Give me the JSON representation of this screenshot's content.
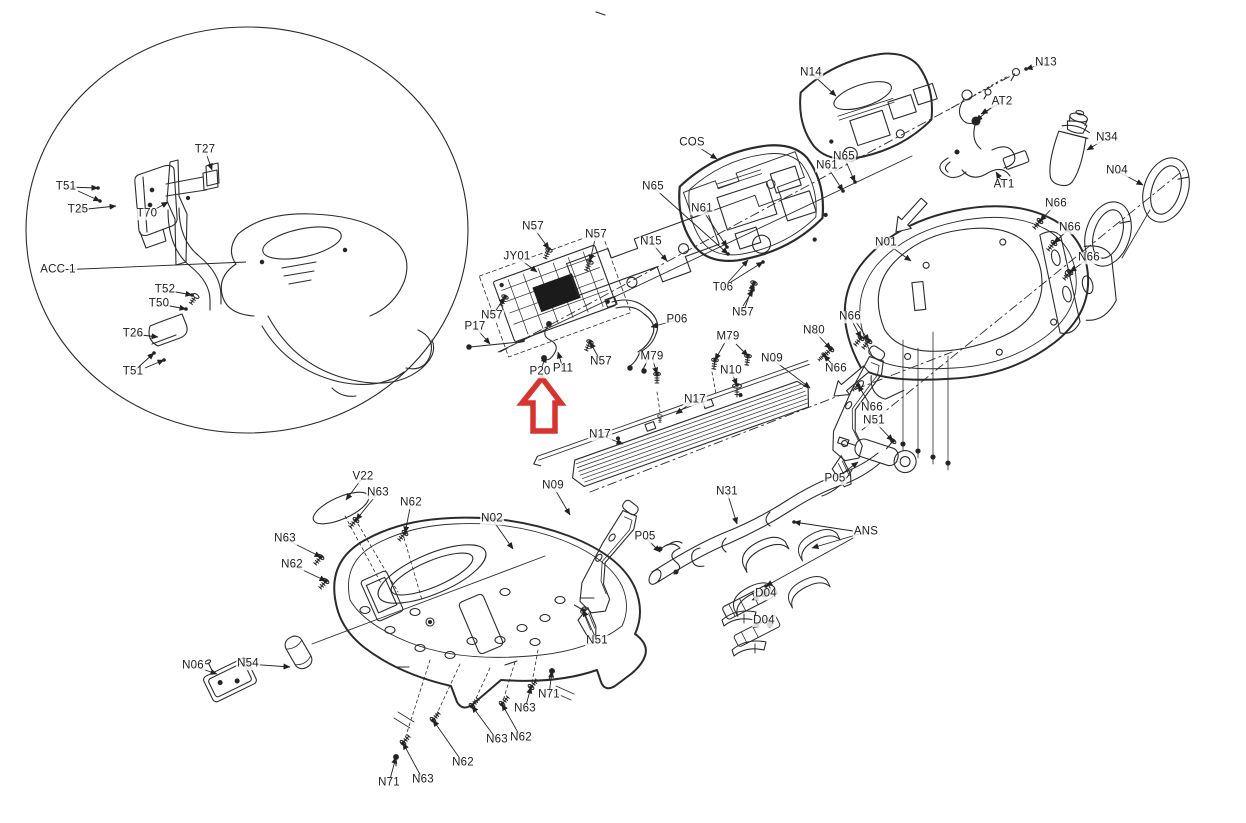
{
  "diagram": {
    "kind": "exploded-parts-diagram",
    "line_color": "#2b2b2b",
    "leader_color": "#222222",
    "label_color": "#1d1d1f",
    "highlight": {
      "icon": "up-arrow",
      "color": "#d7342e"
    }
  },
  "labels": [
    {
      "text": "T27",
      "x": 205,
      "y": 150,
      "lx": 212,
      "ly": 170
    },
    {
      "text": "T51",
      "x": 66,
      "y": 187,
      "lx": 98,
      "ly": 188,
      "hw": true
    },
    {
      "text": "T25",
      "x": 78,
      "y": 210,
      "lx": 116,
      "ly": 206
    },
    {
      "text": "T70",
      "x": 147,
      "y": 214,
      "lx": 168,
      "ly": 202
    },
    {
      "text": "ACC-1",
      "x": 58,
      "y": 270,
      "lx": 246,
      "ly": 262,
      "arrow": false
    },
    {
      "text": "T52",
      "x": 165,
      "y": 290,
      "lx": 192,
      "ly": 295,
      "hw": true
    },
    {
      "text": "T50",
      "x": 159,
      "y": 304,
      "lx": 186,
      "ly": 309,
      "hw": true
    },
    {
      "text": "T26",
      "x": 133,
      "y": 334,
      "lx": 158,
      "ly": 337
    },
    {
      "text": "T51",
      "x": 133,
      "y": 372,
      "lx": 154,
      "ly": 353,
      "hw": true
    },
    {
      "text": "N14",
      "x": 811,
      "y": 73,
      "lx": 836,
      "ly": 96
    },
    {
      "text": "N13",
      "x": 1046,
      "y": 63,
      "lx": 1026,
      "ly": 69,
      "hw": true
    },
    {
      "text": "AT2",
      "x": 1002,
      "y": 102,
      "lx": 981,
      "ly": 114
    },
    {
      "text": "AT1",
      "x": 1004,
      "y": 185,
      "lx": 996,
      "ly": 172
    },
    {
      "text": "N34",
      "x": 1107,
      "y": 138,
      "lx": 1087,
      "ly": 150
    },
    {
      "text": "N04",
      "x": 1117,
      "y": 171,
      "lx": 1143,
      "ly": 185
    },
    {
      "text": "COS",
      "x": 692,
      "y": 143,
      "lx": 717,
      "ly": 159
    },
    {
      "text": "N65",
      "x": 844,
      "y": 157,
      "lx": 855,
      "ly": 182,
      "hw": true
    },
    {
      "text": "N61",
      "x": 827,
      "y": 166,
      "lx": 843,
      "ly": 191,
      "hw": true
    },
    {
      "text": "N65",
      "x": 653,
      "y": 187,
      "lx": 728,
      "ly": 254,
      "hw": true
    },
    {
      "text": "N61",
      "x": 702,
      "y": 209,
      "lx": 727,
      "ly": 247,
      "hw": true
    },
    {
      "text": "N15",
      "x": 651,
      "y": 242,
      "lx": 667,
      "ly": 261
    },
    {
      "text": "N01",
      "x": 886,
      "y": 243,
      "lx": 911,
      "ly": 261
    },
    {
      "text": "N66",
      "x": 1056,
      "y": 204,
      "lx": 1040,
      "ly": 221,
      "hw": true
    },
    {
      "text": "N66",
      "x": 1070,
      "y": 228,
      "lx": 1054,
      "ly": 243,
      "hw": true
    },
    {
      "text": "N66",
      "x": 1089,
      "y": 258,
      "lx": 1070,
      "ly": 272,
      "hw": true
    },
    {
      "text": "N57",
      "x": 533,
      "y": 227,
      "lx": 549,
      "ly": 249,
      "hw": true
    },
    {
      "text": "N57",
      "x": 596,
      "y": 235,
      "lx": 590,
      "ly": 261,
      "hw": true
    },
    {
      "text": "JY01",
      "x": 517,
      "y": 257,
      "lx": 537,
      "ly": 272
    },
    {
      "text": "N57",
      "x": 492,
      "y": 316,
      "lx": 505,
      "ly": 297,
      "hw": true
    },
    {
      "text": "P17",
      "x": 475,
      "y": 327,
      "lx": 490,
      "ly": 344
    },
    {
      "text": "P06",
      "x": 677,
      "y": 320,
      "lx": 651,
      "ly": 327
    },
    {
      "text": "T06",
      "x": 723,
      "y": 288,
      "lx": 748,
      "ly": 260
    },
    {
      "text": "N57",
      "x": 743,
      "y": 313,
      "lx": 754,
      "ly": 283,
      "hw": true
    },
    {
      "text": "P20",
      "x": 540,
      "y": 372,
      "lx": 546,
      "ly": 356
    },
    {
      "text": "P11",
      "x": 563,
      "y": 369,
      "lx": 558,
      "ly": 352
    },
    {
      "text": "N57",
      "x": 601,
      "y": 362,
      "lx": 590,
      "ly": 342,
      "hw": true
    },
    {
      "text": "M79",
      "x": 652,
      "y": 357,
      "lx": 657,
      "ly": 374,
      "hw": true
    },
    {
      "text": "M79",
      "x": 728,
      "y": 337,
      "lx": 715,
      "ly": 360,
      "hw": true
    },
    {
      "text": "N10",
      "x": 731,
      "y": 371,
      "lx": 737,
      "ly": 385,
      "hw": true
    },
    {
      "text": "N17",
      "x": 695,
      "y": 400,
      "lx": 676,
      "ly": 414
    },
    {
      "text": "N17",
      "x": 600,
      "y": 435,
      "lx": 623,
      "ly": 444
    },
    {
      "text": "N09",
      "x": 772,
      "y": 359,
      "lx": 810,
      "ly": 388
    },
    {
      "text": "N80",
      "x": 814,
      "y": 331,
      "lx": 831,
      "ly": 349,
      "hw": true
    },
    {
      "text": "N66",
      "x": 850,
      "y": 317,
      "lx": 861,
      "ly": 338,
      "hw": true
    },
    {
      "text": "N66",
      "x": 836,
      "y": 369,
      "lx": 824,
      "ly": 355,
      "hw": true
    },
    {
      "text": "N66",
      "x": 872,
      "y": 408,
      "lx": 858,
      "ly": 385,
      "hw": true
    },
    {
      "text": "N51",
      "x": 874,
      "y": 421,
      "lx": 893,
      "ly": 441,
      "hw": true
    },
    {
      "text": "P05",
      "x": 835,
      "y": 479,
      "lx": 858,
      "ly": 462
    },
    {
      "text": "N09",
      "x": 553,
      "y": 486,
      "lx": 570,
      "ly": 515
    },
    {
      "text": "N31",
      "x": 727,
      "y": 492,
      "lx": 737,
      "ly": 524
    },
    {
      "text": "P05",
      "x": 645,
      "y": 537,
      "lx": 660,
      "ly": 552
    },
    {
      "text": "ANS",
      "x": 866,
      "y": 532,
      "lx": 812,
      "ly": 548
    },
    {
      "text": "D04",
      "x": 766,
      "y": 594,
      "lx": 752,
      "ly": 600
    },
    {
      "text": "D04",
      "x": 764,
      "y": 621,
      "lx": 753,
      "ly": 628
    },
    {
      "text": "V22",
      "x": 363,
      "y": 477,
      "lx": 346,
      "ly": 500
    },
    {
      "text": "N63",
      "x": 378,
      "y": 493,
      "lx": 356,
      "ly": 520,
      "hw": true
    },
    {
      "text": "N62",
      "x": 411,
      "y": 503,
      "lx": 405,
      "ly": 533,
      "hw": true
    },
    {
      "text": "N02",
      "x": 492,
      "y": 519,
      "lx": 513,
      "ly": 549
    },
    {
      "text": "N63",
      "x": 285,
      "y": 539,
      "lx": 321,
      "ly": 557,
      "hw": true
    },
    {
      "text": "N62",
      "x": 292,
      "y": 565,
      "lx": 326,
      "ly": 581,
      "hw": true
    },
    {
      "text": "N06",
      "x": 193,
      "y": 666,
      "lx": 217,
      "ly": 674
    },
    {
      "text": "N54",
      "x": 248,
      "y": 664,
      "lx": 290,
      "ly": 667
    },
    {
      "text": "N51",
      "x": 597,
      "y": 641,
      "lx": 583,
      "ly": 610,
      "hw": true
    },
    {
      "text": "N71",
      "x": 549,
      "y": 695,
      "lx": 552,
      "ly": 671,
      "hw": true
    },
    {
      "text": "N63",
      "x": 525,
      "y": 709,
      "lx": 531,
      "ly": 687,
      "hw": true
    },
    {
      "text": "N63",
      "x": 497,
      "y": 740,
      "lx": 472,
      "ly": 706,
      "hw": true
    },
    {
      "text": "N62",
      "x": 521,
      "y": 738,
      "lx": 502,
      "ly": 704,
      "hw": true
    },
    {
      "text": "N62",
      "x": 463,
      "y": 763,
      "lx": 433,
      "ly": 720,
      "hw": true
    },
    {
      "text": "N63",
      "x": 423,
      "y": 780,
      "lx": 403,
      "ly": 743,
      "hw": true
    },
    {
      "text": "N71",
      "x": 389,
      "y": 783,
      "lx": 396,
      "ly": 757,
      "hw": true
    }
  ],
  "extra_leaders": [
    {
      "x1": 78,
      "y1": 191,
      "x2": 100,
      "y2": 201
    },
    {
      "x1": 145,
      "y1": 368,
      "x2": 164,
      "y2": 360
    },
    {
      "x1": 736,
      "y1": 344,
      "x2": 748,
      "y2": 356
    },
    {
      "x1": 731,
      "y1": 282,
      "x2": 763,
      "y2": 262
    },
    {
      "x1": 743,
      "y1": 306,
      "x2": 753,
      "y2": 290
    },
    {
      "x1": 856,
      "y1": 322,
      "x2": 869,
      "y2": 341
    },
    {
      "x1": 853,
      "y1": 531,
      "x2": 794,
      "y2": 522
    },
    {
      "x1": 855,
      "y1": 537,
      "x2": 766,
      "y2": 586
    },
    {
      "x1": 993,
      "y1": 106,
      "x2": 976,
      "y2": 121
    }
  ]
}
